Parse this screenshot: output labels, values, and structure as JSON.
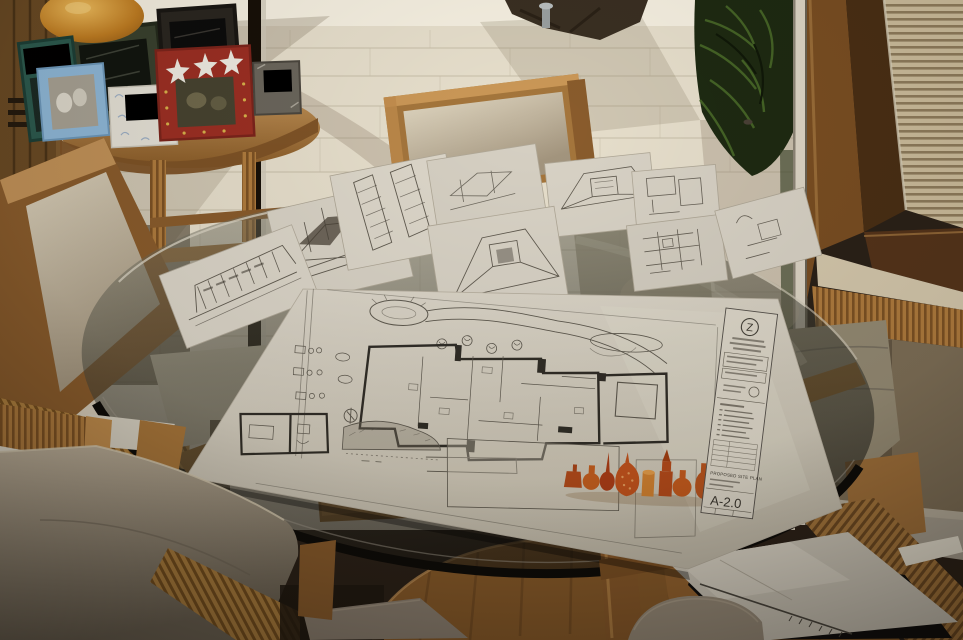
{
  "photo": {
    "description": "Dim interior dining room; round glass table on a rattan-wood pedestal covered with architectural sketch sheets and one large site plan; cream upholstered wood chairs; side table with picture frames (photos blacked out); bright travertine patio with tropical plants seen through open sliding glass doors; louvered shutter panel at top right."
  },
  "drawing_sheet": {
    "logo_letter": "Z",
    "sheet_title": "PROPOSED SITE PLAN",
    "sheet_number": "A-2.0"
  },
  "objects": {
    "sketch_sheet_count": 9,
    "picture_frame_count": 7,
    "bottle_illustration_count": 9,
    "redacted_photo_count": 4
  },
  "colors": {
    "wood": "#9a6a35",
    "rattan_light": "#c08c4c",
    "upholstery": "#cfc3ae",
    "paper": "#d9d3c6",
    "glass_tint": "#3a3b31",
    "outdoor_tile": "#e7dfcc",
    "plant_green": "#1e2a12",
    "bottle_orange": "#bf5620",
    "portfolio_black": "#0d0d0d",
    "redaction_black": "#000000"
  }
}
